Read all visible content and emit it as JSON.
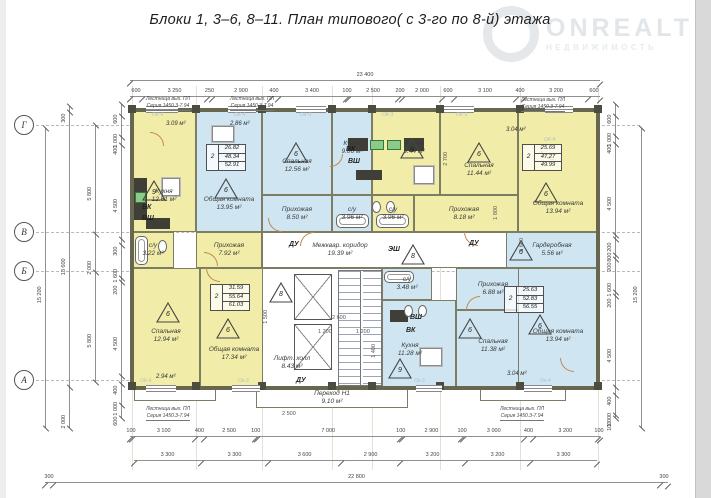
{
  "title": "Блоки 1,  3–6, 8–11.    План типового( с 3-го по 8-й) этажа",
  "watermark": {
    "brand": "ONREALT",
    "subtitle": "НЕДВИЖИМОСТЬ"
  },
  "grid": {
    "axes": [
      {
        "label": "Г",
        "y": 125
      },
      {
        "label": "В",
        "y": 232
      },
      {
        "label": "Б",
        "y": 271
      },
      {
        "label": "А",
        "y": 380
      }
    ],
    "cols_x": [
      132,
      196,
      262,
      332,
      372,
      440,
      520,
      598
    ]
  },
  "plan": {
    "rooms": [
      {
        "id": "kitchen-1261",
        "name": "Кухня",
        "area": "12.61 м²",
        "x": 132,
        "y": 110,
        "w": 64,
        "h": 122,
        "f": "y",
        "lcy": 196
      },
      {
        "id": "living-1395",
        "name": "Общая комната",
        "area": "13.95 м²",
        "x": 196,
        "y": 110,
        "w": 66,
        "h": 122,
        "f": "b",
        "lcy": 204
      },
      {
        "id": "bedroom-1256",
        "name": "Спальная",
        "area": "12.56 м²",
        "x": 262,
        "y": 110,
        "w": 70,
        "h": 85,
        "f": "b",
        "lcy": 166
      },
      {
        "id": "hall-850",
        "name": "Прихожая",
        "area": "8.50 м²",
        "x": 262,
        "y": 195,
        "w": 70,
        "h": 37,
        "f": "b"
      },
      {
        "id": "kitchen-906",
        "name": "Кухня",
        "area": "9.06 м²",
        "x": 332,
        "y": 110,
        "w": 40,
        "h": 85,
        "f": "b",
        "lcy": 148
      },
      {
        "id": "su-396a",
        "name": "с/у",
        "area": "3.96 м²",
        "x": 332,
        "y": 195,
        "w": 40,
        "h": 37,
        "f": "b"
      },
      {
        "id": "su-396b",
        "name": "с/у",
        "area": "3.96 м²",
        "x": 372,
        "y": 195,
        "w": 42,
        "h": 37,
        "f": "y"
      },
      {
        "id": "kitchen-944",
        "name": "Кухня",
        "area": "9.44 м²",
        "x": 372,
        "y": 110,
        "w": 68,
        "h": 85,
        "f": "y",
        "lcx": 414,
        "lcy": 148
      },
      {
        "id": "bedroom-1144",
        "name": "Спальная",
        "area": "11.44 м²",
        "x": 440,
        "y": 110,
        "w": 78,
        "h": 85,
        "f": "y",
        "lcy": 170
      },
      {
        "id": "hall-818",
        "name": "Прихожая",
        "area": "8.18 м²",
        "x": 414,
        "y": 195,
        "w": 104,
        "h": 37,
        "f": "y",
        "lcx": 464
      },
      {
        "id": "living-1394-tr",
        "name": "Общая комната",
        "area": "13.94 м²",
        "x": 518,
        "y": 110,
        "w": 80,
        "h": 122,
        "f": "y",
        "lcy": 208
      },
      {
        "id": "su-322",
        "name": "с/у",
        "area": "3.22 м²",
        "x": 132,
        "y": 232,
        "w": 42,
        "h": 36,
        "f": "y"
      },
      {
        "id": "hall-792",
        "name": "Прихожая",
        "area": "7.92 м²",
        "x": 196,
        "y": 232,
        "w": 66,
        "h": 36,
        "f": "y"
      },
      {
        "id": "corridor-1939",
        "name": "Межквар. коридор",
        "area": "19.39 м²",
        "x": 262,
        "y": 232,
        "w": 256,
        "h": 36,
        "f": "w",
        "lcx": 340
      },
      {
        "id": "bedroom-1294",
        "name": "Спальная",
        "area": "12.94 м²",
        "x": 132,
        "y": 268,
        "w": 68,
        "h": 120,
        "f": "y",
        "lcy": 336
      },
      {
        "id": "living-1734",
        "name": "Общая комната",
        "area": "17.34 м²",
        "x": 200,
        "y": 268,
        "w": 68,
        "h": 120,
        "f": "y",
        "lcy": 354
      },
      {
        "id": "core",
        "name": "",
        "area": "",
        "x": 262,
        "y": 268,
        "w": 120,
        "h": 120,
        "f": "w"
      },
      {
        "id": "su-348",
        "name": "с/у",
        "area": "3.48 м²",
        "x": 382,
        "y": 268,
        "w": 50,
        "h": 32,
        "f": "b"
      },
      {
        "id": "hall-688",
        "name": "Прихожая",
        "area": "6.88 м²",
        "x": 456,
        "y": 268,
        "w": 74,
        "h": 42,
        "f": "b"
      },
      {
        "id": "kitchen-1128",
        "name": "Кухня",
        "area": "11.28 м²",
        "x": 382,
        "y": 300,
        "w": 74,
        "h": 88,
        "f": "b",
        "lcx": 410,
        "lcy": 350
      },
      {
        "id": "bedroom-1138",
        "name": "Спальная",
        "area": "11.38 м²",
        "x": 456,
        "y": 310,
        "w": 74,
        "h": 78,
        "f": "b",
        "lcy": 346
      },
      {
        "id": "wardrobe-556",
        "name": "Гардеробная",
        "area": "5.56 м²",
        "x": 506,
        "y": 232,
        "w": 92,
        "h": 36,
        "f": "b"
      },
      {
        "id": "living-1394-br",
        "name": "Общая комната",
        "area": "13.94 м²",
        "x": 518,
        "y": 268,
        "w": 80,
        "h": 120,
        "f": "b",
        "lcy": 336
      },
      {
        "id": "perehod-910",
        "name": "Переход Н1",
        "area": "9.10 м²",
        "x": 256,
        "y": 388,
        "w": 152,
        "h": 20,
        "f": "w"
      },
      {
        "id": "lift-hall-843",
        "name": "Лифт. холл",
        "area": "8.43 м²",
        "x": 262,
        "y": 340,
        "w": 60,
        "h": 46,
        "f": "w",
        "nb": true
      },
      {
        "id": "balcony-bl",
        "name": "",
        "area": "",
        "x": 134,
        "y": 388,
        "w": 82,
        "h": 13,
        "f": "w"
      },
      {
        "id": "balcony-br",
        "name": "",
        "area": "",
        "x": 480,
        "y": 388,
        "w": 86,
        "h": 13,
        "f": "w"
      }
    ],
    "stamps": [
      {
        "x": 206,
        "y": 144,
        "rooms": "2",
        "values": [
          "26.82",
          "48.34",
          "52.91"
        ]
      },
      {
        "x": 522,
        "y": 144,
        "rooms": "2",
        "values": [
          "25.69",
          "47.27",
          "49.99"
        ]
      },
      {
        "x": 210,
        "y": 284,
        "rooms": "2",
        "values": [
          "31.59",
          "55.64",
          "61.03"
        ]
      },
      {
        "x": 504,
        "y": 286,
        "rooms": "2",
        "values": [
          "25.63",
          "52.83",
          "56.55"
        ]
      }
    ],
    "triangles": [
      {
        "n": "9",
        "x": 142,
        "y": 180
      },
      {
        "n": "6",
        "x": 214,
        "y": 178
      },
      {
        "n": "6",
        "x": 284,
        "y": 142
      },
      {
        "n": "9",
        "x": 400,
        "y": 138
      },
      {
        "n": "6",
        "x": 467,
        "y": 142
      },
      {
        "n": "6",
        "x": 534,
        "y": 182
      },
      {
        "n": "8",
        "x": 269,
        "y": 282
      },
      {
        "n": "8",
        "x": 401,
        "y": 244
      },
      {
        "n": "6",
        "x": 156,
        "y": 302
      },
      {
        "n": "6",
        "x": 216,
        "y": 318
      },
      {
        "n": "9",
        "x": 388,
        "y": 358
      },
      {
        "n": "6",
        "x": 458,
        "y": 318
      },
      {
        "n": "6",
        "x": 528,
        "y": 314
      },
      {
        "n": "6",
        "x": 509,
        "y": 240
      }
    ],
    "tags": [
      {
        "t": "ВК",
        "x": 142,
        "y": 204,
        "c": "b"
      },
      {
        "t": "ВШ",
        "x": 142,
        "y": 215,
        "c": "b"
      },
      {
        "t": "ВК",
        "x": 346,
        "y": 146,
        "c": "b"
      },
      {
        "t": "ВШ",
        "x": 348,
        "y": 158,
        "c": "b"
      },
      {
        "t": "ВШ",
        "x": 410,
        "y": 314,
        "c": "b"
      },
      {
        "t": "ВК",
        "x": 406,
        "y": 327,
        "c": "b"
      },
      {
        "t": "ЭШ",
        "x": 388,
        "y": 246,
        "c": "b"
      },
      {
        "t": "ДУ",
        "x": 289,
        "y": 241,
        "c": "b"
      },
      {
        "t": "ДУ",
        "x": 469,
        "y": 240,
        "c": "b"
      },
      {
        "t": "ДУ",
        "x": 296,
        "y": 377,
        "c": "b"
      },
      {
        "t": "3.09 м²",
        "x": 166,
        "y": 121,
        "c": "a"
      },
      {
        "t": "2.86 м²",
        "x": 230,
        "y": 121,
        "c": "a"
      },
      {
        "t": "3.04 м²",
        "x": 506,
        "y": 127,
        "c": "a"
      },
      {
        "t": "2.94 м²",
        "x": 156,
        "y": 374,
        "c": "a"
      },
      {
        "t": "3.04 м²",
        "x": 507,
        "y": 371,
        "c": "a"
      },
      {
        "t": "ОК-4",
        "x": 152,
        "y": 113,
        "c": "o"
      },
      {
        "t": "ОК-4",
        "x": 234,
        "y": 113,
        "c": "o"
      },
      {
        "t": "ОК-3",
        "x": 300,
        "y": 113,
        "c": "o"
      },
      {
        "t": "ОК-3",
        "x": 382,
        "y": 113,
        "c": "o"
      },
      {
        "t": "ОК-3",
        "x": 456,
        "y": 113,
        "c": "o"
      },
      {
        "t": "ОК-4",
        "x": 544,
        "y": 138,
        "c": "o"
      },
      {
        "t": "ОК-4",
        "x": 140,
        "y": 379,
        "c": "o"
      },
      {
        "t": "Ок-3",
        "x": 238,
        "y": 379,
        "c": "o"
      },
      {
        "t": "Ок-3",
        "x": 414,
        "y": 379,
        "c": "o"
      },
      {
        "t": "Ок-4",
        "x": 540,
        "y": 379,
        "c": "o"
      }
    ],
    "stair_note": {
      "line1": "Лестница вых. ПЛ",
      "line2": "Серия 1450.3-7.94"
    },
    "stair_labels": [
      {
        "x": 168,
        "y": 96
      },
      {
        "x": 252,
        "y": 96
      },
      {
        "x": 543,
        "y": 97
      },
      {
        "x": 168,
        "y": 406
      },
      {
        "x": 522,
        "y": 406
      }
    ],
    "fixtures": [
      {
        "t": "steps",
        "x": 338,
        "y": 270,
        "w": 44,
        "h": 116
      },
      {
        "t": "elev",
        "x": 294,
        "y": 274,
        "w": 38,
        "h": 46
      },
      {
        "t": "elev",
        "x": 294,
        "y": 324,
        "w": 38,
        "h": 46
      },
      {
        "t": "counter",
        "x": 134,
        "y": 178,
        "w": 13,
        "h": 42
      },
      {
        "t": "sink",
        "x": 135,
        "y": 192,
        "w": 11,
        "h": 11
      },
      {
        "t": "counter",
        "x": 348,
        "y": 138,
        "w": 20,
        "h": 13
      },
      {
        "t": "counter",
        "x": 404,
        "y": 138,
        "w": 20,
        "h": 13
      },
      {
        "t": "sink",
        "x": 370,
        "y": 140,
        "w": 14,
        "h": 10
      },
      {
        "t": "sink",
        "x": 387,
        "y": 140,
        "w": 14,
        "h": 10
      },
      {
        "t": "dark",
        "x": 356,
        "y": 170,
        "w": 26,
        "h": 10
      },
      {
        "t": "dark",
        "x": 146,
        "y": 218,
        "w": 24,
        "h": 11
      },
      {
        "t": "dark",
        "x": 390,
        "y": 310,
        "w": 18,
        "h": 12
      },
      {
        "t": "table",
        "x": 162,
        "y": 178,
        "w": 18,
        "h": 18
      },
      {
        "t": "table",
        "x": 212,
        "y": 126,
        "w": 22,
        "h": 16
      },
      {
        "t": "table",
        "x": 414,
        "y": 166,
        "w": 20,
        "h": 18
      },
      {
        "t": "table",
        "x": 420,
        "y": 348,
        "w": 22,
        "h": 18
      },
      {
        "t": "tub",
        "x": 336,
        "y": 214,
        "w": 33,
        "h": 14
      },
      {
        "t": "tub",
        "x": 376,
        "y": 214,
        "w": 33,
        "h": 14
      },
      {
        "t": "tubv",
        "x": 135,
        "y": 236,
        "w": 13,
        "h": 29
      },
      {
        "t": "tub",
        "x": 384,
        "y": 271,
        "w": 30,
        "h": 12
      },
      {
        "t": "wc",
        "x": 158,
        "y": 240,
        "w": 9,
        "h": 13
      },
      {
        "t": "wc",
        "x": 372,
        "y": 201,
        "w": 9,
        "h": 12
      },
      {
        "t": "wc",
        "x": 386,
        "y": 201,
        "w": 9,
        "h": 12
      },
      {
        "t": "wc",
        "x": 404,
        "y": 305,
        "w": 9,
        "h": 12
      },
      {
        "t": "wc",
        "x": 418,
        "y": 305,
        "w": 9,
        "h": 12
      },
      {
        "t": "win",
        "x": 146,
        "y": 106,
        "w": 32,
        "h": 7
      },
      {
        "t": "win",
        "x": 228,
        "y": 106,
        "w": 28,
        "h": 7
      },
      {
        "t": "win",
        "x": 296,
        "y": 106,
        "w": 30,
        "h": 7
      },
      {
        "t": "win",
        "x": 444,
        "y": 106,
        "w": 30,
        "h": 7
      },
      {
        "t": "win",
        "x": 545,
        "y": 106,
        "w": 28,
        "h": 7
      },
      {
        "t": "win",
        "x": 146,
        "y": 385,
        "w": 30,
        "h": 7
      },
      {
        "t": "win",
        "x": 232,
        "y": 385,
        "w": 28,
        "h": 7
      },
      {
        "t": "win",
        "x": 416,
        "y": 385,
        "w": 26,
        "h": 7
      },
      {
        "t": "win",
        "x": 524,
        "y": 385,
        "w": 28,
        "h": 7
      },
      {
        "t": "door",
        "x": 268,
        "y": 218,
        "w": 14,
        "h": 14,
        "r": 0
      },
      {
        "t": "door",
        "x": 300,
        "y": 232,
        "w": 14,
        "h": 14,
        "r": 1
      },
      {
        "t": "door",
        "x": 464,
        "y": 232,
        "w": 14,
        "h": 14,
        "r": 0
      },
      {
        "t": "door",
        "x": 204,
        "y": 252,
        "w": 14,
        "h": 14,
        "r": 2
      },
      {
        "t": "door",
        "x": 330,
        "y": 154,
        "w": 13,
        "h": 13,
        "r": 3
      },
      {
        "t": "door",
        "x": 206,
        "y": 268,
        "w": 14,
        "h": 14,
        "r": 0
      },
      {
        "t": "door",
        "x": 466,
        "y": 296,
        "w": 14,
        "h": 14,
        "r": 1
      },
      {
        "t": "door",
        "x": 540,
        "y": 146,
        "w": 14,
        "h": 14,
        "r": 0
      },
      {
        "t": "door",
        "x": 150,
        "y": 132,
        "w": 14,
        "h": 14,
        "r": 2
      },
      {
        "t": "door",
        "x": 560,
        "y": 358,
        "w": 14,
        "h": 14,
        "r": 0
      }
    ],
    "dims": {
      "h_rows": [
        {
          "y": 72,
          "x0": 130,
          "x1": 600,
          "values": [
            "23 400"
          ]
        },
        {
          "y": 88,
          "x0": 130,
          "x1": 600,
          "values": [
            "600",
            "3 250",
            "250",
            "2 900",
            "400",
            "3 400",
            "100",
            "2 500",
            "200",
            "2 000",
            "600",
            "3 100",
            "400",
            "3 200",
            "600"
          ]
        },
        {
          "y": 428,
          "x0": 130,
          "x1": 600,
          "values": [
            "100",
            "3 100",
            "400",
            "2 500",
            "100",
            "7 000",
            "100",
            "2 900",
            "100",
            "3 000",
            "400",
            "3 200",
            "100"
          ]
        },
        {
          "y": 452,
          "x0": 134,
          "x1": 597,
          "values": [
            "3 300",
            "3 300",
            "3 600",
            "2 900",
            "3 200",
            "3 200",
            "3 300"
          ]
        },
        {
          "y": 474,
          "x0": 45,
          "x1": 668,
          "values": [
            "300",
            "22 800",
            "300"
          ]
        }
      ],
      "v_cols": [
        {
          "x": 36,
          "y0": 128,
          "y1": 428,
          "values": [
            "15 200"
          ]
        },
        {
          "x": 60,
          "y0": 106,
          "y1": 428,
          "values": [
            "300",
            "13 600",
            "2 000"
          ]
        },
        {
          "x": 86,
          "y0": 125,
          "y1": 382,
          "values": [
            "5 800",
            "2 000",
            "5 800"
          ]
        },
        {
          "x": 112,
          "y0": 104,
          "y1": 418,
          "values": [
            "600",
            "1 000",
            "400",
            "4 500",
            "300",
            "1 600",
            "200",
            "4 500",
            "400",
            "1 000",
            "600"
          ]
        },
        {
          "x": 606,
          "y0": 104,
          "y1": 418,
          "values": [
            "600",
            "1 000",
            "400",
            "4 500",
            "200",
            "800",
            "200",
            "1 600",
            "200",
            "4 500",
            "400",
            "1 000",
            "100"
          ]
        },
        {
          "x": 632,
          "y0": 128,
          "y1": 428,
          "values": [
            "15 200"
          ]
        }
      ],
      "inner": [
        {
          "t": "2 600",
          "x": 332,
          "y": 316
        },
        {
          "t": "1 200",
          "x": 318,
          "y": 330
        },
        {
          "t": "1 200",
          "x": 356,
          "y": 330
        },
        {
          "t": "2 500",
          "x": 282,
          "y": 412
        },
        {
          "t": "1 400",
          "x": 372,
          "y": 344,
          "r": 1
        },
        {
          "t": "1 800",
          "x": 494,
          "y": 206,
          "r": 1
        },
        {
          "t": "2 700",
          "x": 444,
          "y": 152,
          "r": 1
        },
        {
          "t": "1 500",
          "x": 264,
          "y": 310,
          "r": 1
        },
        {
          "t": "1 600",
          "x": 520,
          "y": 238,
          "r": 1
        }
      ]
    }
  }
}
